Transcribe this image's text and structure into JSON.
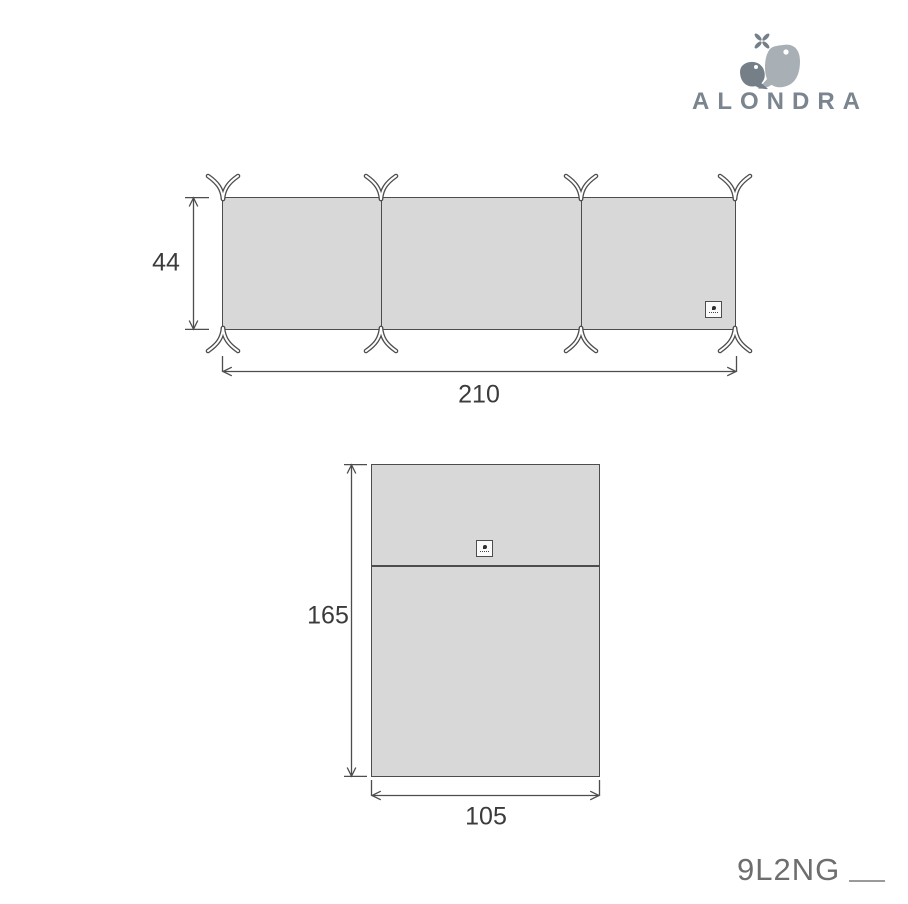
{
  "brand": {
    "name": "ALONDRA",
    "colors": {
      "wordmark": "#7a858f",
      "bird_light": "#a9b0b5",
      "bird_dark": "#747f88"
    }
  },
  "diagrams": {
    "bumper": {
      "height_label": "44",
      "width_label": "210",
      "panels": 3,
      "ties": 8,
      "fill_color": "#d8d8d8",
      "line_color": "#4d4d4d"
    },
    "duvet": {
      "height_label": "165",
      "width_label": "105",
      "fill_color": "#d8d8d8",
      "line_color": "#4d4d4d"
    }
  },
  "footer": {
    "product_code": "9L2NG"
  }
}
